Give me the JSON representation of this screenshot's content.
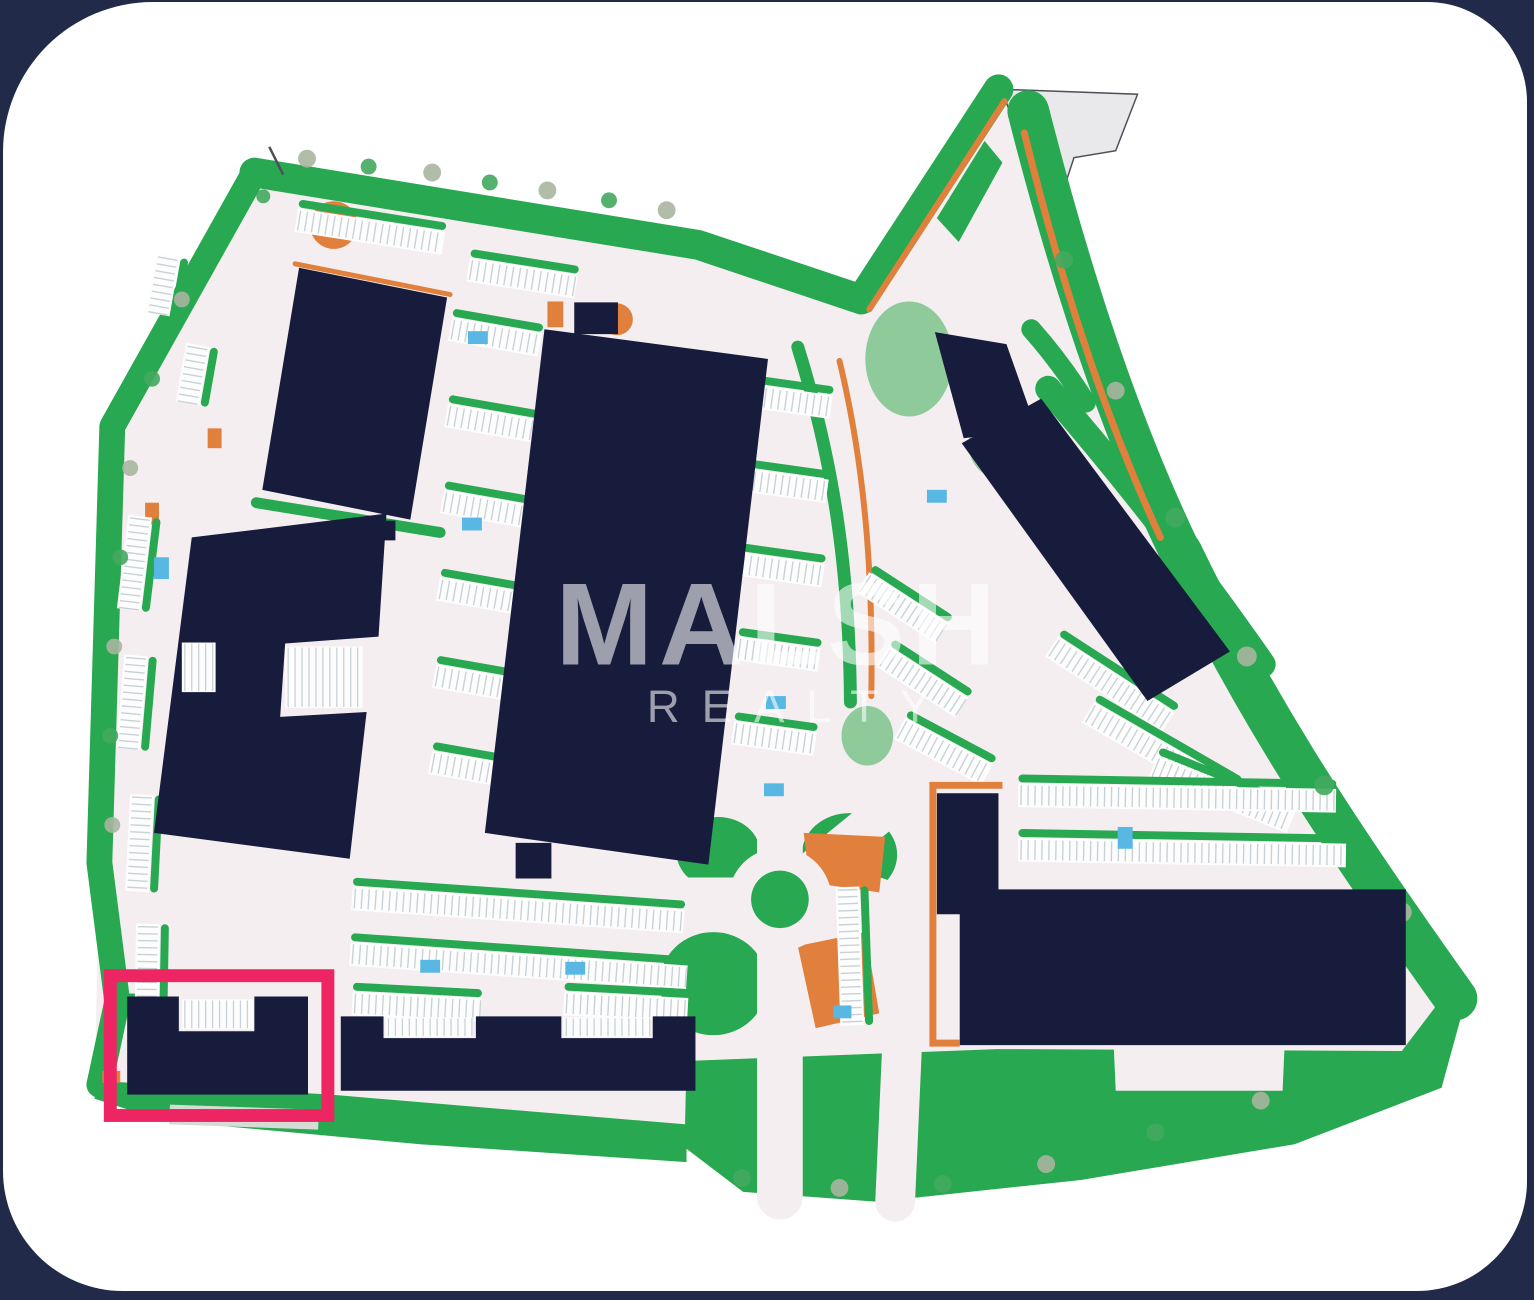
{
  "frame": {
    "background": "#212a49",
    "canvas": "#ffffff"
  },
  "palette": {
    "building": "#171c3c",
    "green": "#27a851",
    "greenSoft": "#7cc38c",
    "treeKhaki": "#a9b5a0",
    "treeGreen": "#43a95e",
    "orange": "#e0803c",
    "road": "#f4eef0",
    "stall": "#c8d2d6",
    "stallBg": "#fdfdfd",
    "blue": "#58b7e3",
    "pink": "#ee2563",
    "pennantFill": "#e9e8ea",
    "pennantStroke": "#4e5058",
    "grayBand": "#d5dcd3",
    "watermark": "rgba(255,255,255,0.58)"
  },
  "watermark": {
    "line1": "MALSH",
    "x1": 556,
    "y1": 668,
    "size1": 118,
    "spacing1": 6,
    "line2": "REALTY",
    "x2": 648,
    "y2": 726,
    "size2": 46,
    "spacing2": 22
  },
  "highlight": {
    "x": 108,
    "y": 982,
    "w": 219,
    "h": 141,
    "strokeWidth": 13
  },
  "plan": {
    "base": "M253 172 L700 245 L864 300 L1002 88 L1032 110 C1070 260 1120 420 1185 555 C1255 700 1330 820 1462 1005 L1468 1022 L1448 1095 L1300 1152 L1085 1188 L880 1210 L745 1200 L686 1155 L420 1152 L160 1128 L92 1106 L97 868 L110 428 Z",
    "pennant": {
      "points": "1005,88 1142,93 1120,150 1078,157 1060,212 1028,150"
    },
    "greenBands": [
      {
        "d": "M253 172 L700 245 L864 300",
        "w": 30
      },
      {
        "d": "M253 172 L110 428 L97 868 L115 1008 L97 1092",
        "w": 26
      },
      {
        "d": "M864 300 L1002 88",
        "w": 30
      },
      {
        "d": "M1032 110 C1070 260 1120 420 1185 555",
        "w": 42
      },
      {
        "d": "M1185 555 C1255 700 1330 820 1462 1005",
        "w": 44
      },
      {
        "d": "M800 348 C838 470 852 580 853 706",
        "w": 13
      },
      {
        "d": "M1052 390 C1130 480 1200 570 1268 668",
        "w": 26
      },
      {
        "d": "M255 505 L440 535",
        "w": 11
      },
      {
        "d": "M1035 330 C1058 356 1075 380 1090 404",
        "w": 20
      }
    ],
    "greenFills": [
      {
        "points": "688,1068 1000,1056 1408,1058 1452,1000 1468,1022 1448,1095 1300,1152 1085,1188 880,1210 745,1200 686,1155"
      },
      {
        "points": "95,1088 330,1102 688,1132 688,1170 420,1152 160,1128 92,1106"
      },
      {
        "points": "940,218 988,140 1006,162 962,242"
      }
    ],
    "greenBlobs": [
      {
        "cx": 720,
        "cy": 858,
        "rx": 42,
        "ry": 36,
        "soft": false
      },
      {
        "cx": 715,
        "cy": 990,
        "rx": 54,
        "ry": 52,
        "soft": false
      },
      {
        "cx": 852,
        "cy": 860,
        "rx": 48,
        "ry": 42,
        "soft": false
      },
      {
        "cx": 912,
        "cy": 360,
        "rx": 44,
        "ry": 58,
        "soft": true
      },
      {
        "cx": 1002,
        "cy": 446,
        "rx": 30,
        "ry": 34,
        "soft": true
      },
      {
        "cx": 870,
        "cy": 740,
        "rx": 26,
        "ry": 30,
        "soft": true
      }
    ],
    "greenRects": [
      {
        "x": 124,
        "y": 1000,
        "w": 30,
        "h": 10
      }
    ],
    "roadsOver": [
      {
        "d": "M690 905 L880 905",
        "w": 44
      },
      {
        "d": "M782 820 L782 1205",
        "w": 46
      },
      {
        "d": "M815 875 L925 785",
        "w": 38
      },
      {
        "d": "M905 1052 L898 1210",
        "w": 40
      }
    ],
    "roadFills": [
      {
        "points": "1118,1052 1290,1052 1288,1098 1120,1098"
      }
    ],
    "orangeLines": [
      {
        "d": "M294 264 L450 295",
        "w": 5
      },
      {
        "d": "M872 310 L1008 100",
        "w": 6
      },
      {
        "d": "M1028 132 C1062 270 1105 410 1165 540",
        "w": 7
      },
      {
        "d": "M842 362 C868 470 876 580 874 700",
        "w": 6
      }
    ],
    "orangeAfterLines": [
      {
        "d": "M1006 790 L936 790 L936 1050 L963 1050",
        "w": 7
      }
    ],
    "orangeShapes": [
      {
        "points": "806,838 888,842 882,898 812,888"
      },
      {
        "points": "800,952 868,938 882,1020 818,1035"
      }
    ],
    "orangeRects": [
      {
        "x": 540,
        "y": 688,
        "w": 20,
        "h": 74
      },
      {
        "x": 548,
        "y": 302,
        "w": 16,
        "h": 26
      },
      {
        "x": 143,
        "y": 505,
        "w": 14,
        "h": 22
      },
      {
        "x": 236,
        "y": 686,
        "w": 30,
        "h": 14
      },
      {
        "x": 100,
        "y": 1078,
        "w": 18,
        "h": 12
      },
      {
        "x": 206,
        "y": 430,
        "w": 14,
        "h": 20
      }
    ],
    "orangeCircles": [
      {
        "cx": 333,
        "cy": 225,
        "r": 24
      },
      {
        "cx": 618,
        "cy": 320,
        "r": 16
      }
    ],
    "roundabout": {
      "cx": 782,
      "cy": 905,
      "rOuter": 52,
      "rInner": 29
    },
    "parkingRows": [
      {
        "x": 297,
        "y": 208,
        "w": 150,
        "rot": 9
      },
      {
        "x": 470,
        "y": 258,
        "w": 110,
        "rot": 9
      },
      {
        "x": 452,
        "y": 318,
        "w": 92,
        "rot": 10
      },
      {
        "x": 448,
        "y": 405,
        "w": 92,
        "rot": 10
      },
      {
        "x": 444,
        "y": 492,
        "w": 92,
        "rot": 10
      },
      {
        "x": 440,
        "y": 580,
        "w": 92,
        "rot": 10
      },
      {
        "x": 436,
        "y": 668,
        "w": 92,
        "rot": 10
      },
      {
        "x": 432,
        "y": 755,
        "w": 92,
        "rot": 10
      },
      {
        "x": 752,
        "y": 385,
        "w": 84,
        "rot": 8
      },
      {
        "x": 748,
        "y": 470,
        "w": 84,
        "rot": 8
      },
      {
        "x": 744,
        "y": 555,
        "w": 84,
        "rot": 8
      },
      {
        "x": 740,
        "y": 640,
        "w": 84,
        "rot": 8
      },
      {
        "x": 736,
        "y": 725,
        "w": 84,
        "rot": 8
      },
      {
        "x": 150,
        "y": 520,
        "w": 95,
        "rot": 97
      },
      {
        "x": 146,
        "y": 660,
        "w": 95,
        "rot": 95
      },
      {
        "x": 152,
        "y": 800,
        "w": 98,
        "rot": 93
      },
      {
        "x": 158,
        "y": 930,
        "w": 88,
        "rot": 91
      },
      {
        "x": 178,
        "y": 258,
        "w": 60,
        "rot": 100
      },
      {
        "x": 208,
        "y": 348,
        "w": 60,
        "rot": 100
      },
      {
        "x": 872,
        "y": 575,
        "w": 95,
        "rot": 33
      },
      {
        "x": 892,
        "y": 650,
        "w": 95,
        "rot": 33
      },
      {
        "x": 908,
        "y": 722,
        "w": 100,
        "rot": 28
      },
      {
        "x": 1062,
        "y": 640,
        "w": 140,
        "rot": 33
      },
      {
        "x": 1098,
        "y": 706,
        "w": 168,
        "rot": 30
      },
      {
        "x": 1162,
        "y": 760,
        "w": 150,
        "rot": 22
      },
      {
        "x": 1022,
        "y": 788,
        "w": 320,
        "rot": 1
      },
      {
        "x": 1022,
        "y": 843,
        "w": 330,
        "rot": 1
      },
      {
        "x": 862,
        "y": 892,
        "w": 140,
        "rot": 88
      },
      {
        "x": 352,
        "y": 892,
        "w": 335,
        "rot": 4
      },
      {
        "x": 350,
        "y": 948,
        "w": 340,
        "rot": 4
      },
      {
        "x": 352,
        "y": 998,
        "w": 130,
        "rot": 3
      },
      {
        "x": 565,
        "y": 998,
        "w": 125,
        "rot": 3
      }
    ],
    "stallPatches": [
      {
        "x": 385,
        "y": 1024,
        "w": 88,
        "h": 20
      },
      {
        "x": 564,
        "y": 1024,
        "w": 88,
        "h": 20
      },
      {
        "x": 180,
        "y": 1006,
        "w": 72,
        "h": 30
      },
      {
        "x": 284,
        "y": 650,
        "w": 78,
        "h": 62
      },
      {
        "x": 180,
        "y": 646,
        "w": 34,
        "h": 50
      }
    ],
    "blueRects": [
      {
        "x": 468,
        "y": 332,
        "w": 20,
        "h": 13
      },
      {
        "x": 462,
        "y": 520,
        "w": 20,
        "h": 13
      },
      {
        "x": 152,
        "y": 560,
        "w": 15,
        "h": 22
      },
      {
        "x": 540,
        "y": 588,
        "w": 20,
        "h": 13
      },
      {
        "x": 768,
        "y": 700,
        "w": 20,
        "h": 13
      },
      {
        "x": 766,
        "y": 788,
        "w": 20,
        "h": 13
      },
      {
        "x": 930,
        "y": 492,
        "w": 20,
        "h": 13
      },
      {
        "x": 1122,
        "y": 832,
        "w": 15,
        "h": 22
      },
      {
        "x": 1136,
        "y": 940,
        "w": 15,
        "h": 22
      },
      {
        "x": 836,
        "y": 1012,
        "w": 18,
        "h": 13
      },
      {
        "x": 566,
        "y": 968,
        "w": 20,
        "h": 13
      },
      {
        "x": 420,
        "y": 966,
        "w": 20,
        "h": 13
      }
    ],
    "trees": [
      {
        "cx": 306,
        "cy": 158,
        "r": 9,
        "c": "k"
      },
      {
        "cx": 368,
        "cy": 166,
        "r": 8,
        "c": "g"
      },
      {
        "cx": 432,
        "cy": 172,
        "r": 9,
        "c": "k"
      },
      {
        "cx": 490,
        "cy": 182,
        "r": 8,
        "c": "g"
      },
      {
        "cx": 548,
        "cy": 190,
        "r": 9,
        "c": "k"
      },
      {
        "cx": 610,
        "cy": 200,
        "r": 8,
        "c": "g"
      },
      {
        "cx": 668,
        "cy": 210,
        "r": 9,
        "c": "k"
      },
      {
        "cx": 262,
        "cy": 196,
        "r": 7,
        "c": "g"
      },
      {
        "cx": 180,
        "cy": 300,
        "r": 8,
        "c": "k"
      },
      {
        "cx": 150,
        "cy": 380,
        "r": 8,
        "c": "g"
      },
      {
        "cx": 128,
        "cy": 470,
        "r": 8,
        "c": "k"
      },
      {
        "cx": 118,
        "cy": 560,
        "r": 8,
        "c": "g"
      },
      {
        "cx": 112,
        "cy": 650,
        "r": 8,
        "c": "k"
      },
      {
        "cx": 108,
        "cy": 740,
        "r": 8,
        "c": "g"
      },
      {
        "cx": 110,
        "cy": 830,
        "r": 8,
        "c": "k"
      },
      {
        "cx": 1068,
        "cy": 260,
        "r": 9,
        "c": "g"
      },
      {
        "cx": 1120,
        "cy": 392,
        "r": 9,
        "c": "k"
      },
      {
        "cx": 1180,
        "cy": 520,
        "r": 10,
        "c": "g"
      },
      {
        "cx": 1252,
        "cy": 660,
        "r": 10,
        "c": "k"
      },
      {
        "cx": 1330,
        "cy": 790,
        "r": 10,
        "c": "g"
      },
      {
        "cx": 1408,
        "cy": 918,
        "r": 10,
        "c": "k"
      },
      {
        "cx": 744,
        "cy": 1186,
        "r": 9,
        "c": "g"
      },
      {
        "cx": 842,
        "cy": 1196,
        "r": 9,
        "c": "k"
      },
      {
        "cx": 946,
        "cy": 1192,
        "r": 9,
        "c": "g"
      },
      {
        "cx": 1050,
        "cy": 1172,
        "r": 9,
        "c": "k"
      },
      {
        "cx": 1160,
        "cy": 1140,
        "r": 9,
        "c": "g"
      },
      {
        "cx": 1266,
        "cy": 1108,
        "r": 9,
        "c": "k"
      }
    ],
    "grayBand": {
      "x": 168,
      "y": 1112,
      "w": 150,
      "h": 20,
      "rot": 2
    },
    "boundaryTick": {
      "x1": 268,
      "y1": 146,
      "x2": 282,
      "y2": 174
    },
    "buildings": [
      {
        "id": "building-top-left",
        "d": "M298 268 L447 298 L410 522 L261 492 Z"
      },
      {
        "id": "building-left-middle",
        "d": "M190 540 L386 516 L378 640 L284 647 L279 721 L366 716 L349 864 L152 838 Z"
      },
      {
        "id": "building-central",
        "d": "M545 330 L770 360 L710 870 L485 838 Z"
      },
      {
        "id": "building-right-tilted",
        "d": "M965 445 L1045 400 L1235 655 L1152 705 Z"
      },
      {
        "id": "building-right-tilted-annex",
        "d": "M938 333 L1010 345 L1040 430 L967 440 Z"
      },
      {
        "id": "building-bottom-right",
        "d": "M940 798 L1002 798 L1002 895 L1412 895 L1412 1052 L963 1052 L963 920 L940 920 Z"
      },
      {
        "id": "building-bottom-center",
        "d": "M340 1023 L383 1023 L383 1045 L476 1045 L476 1023 L562 1023 L562 1045 L654 1045 L654 1023 L697 1023 L697 1098 L340 1098 Z"
      },
      {
        "id": "building-highlighted-lot",
        "d": "M125 1003 L177 1003 L177 1038 L253 1038 L253 1003 L307 1003 L307 1102 L125 1102 Z"
      },
      {
        "id": "building-small-north",
        "d": "M575 303 L619 303 L619 335 L575 335 Z"
      },
      {
        "id": "building-small-mid",
        "d": "M516 848 L552 848 L552 884 L516 884 Z"
      },
      {
        "id": "building-small-gap",
        "d": "M377 523 L395 523 L395 543 L377 543 Z"
      }
    ]
  }
}
